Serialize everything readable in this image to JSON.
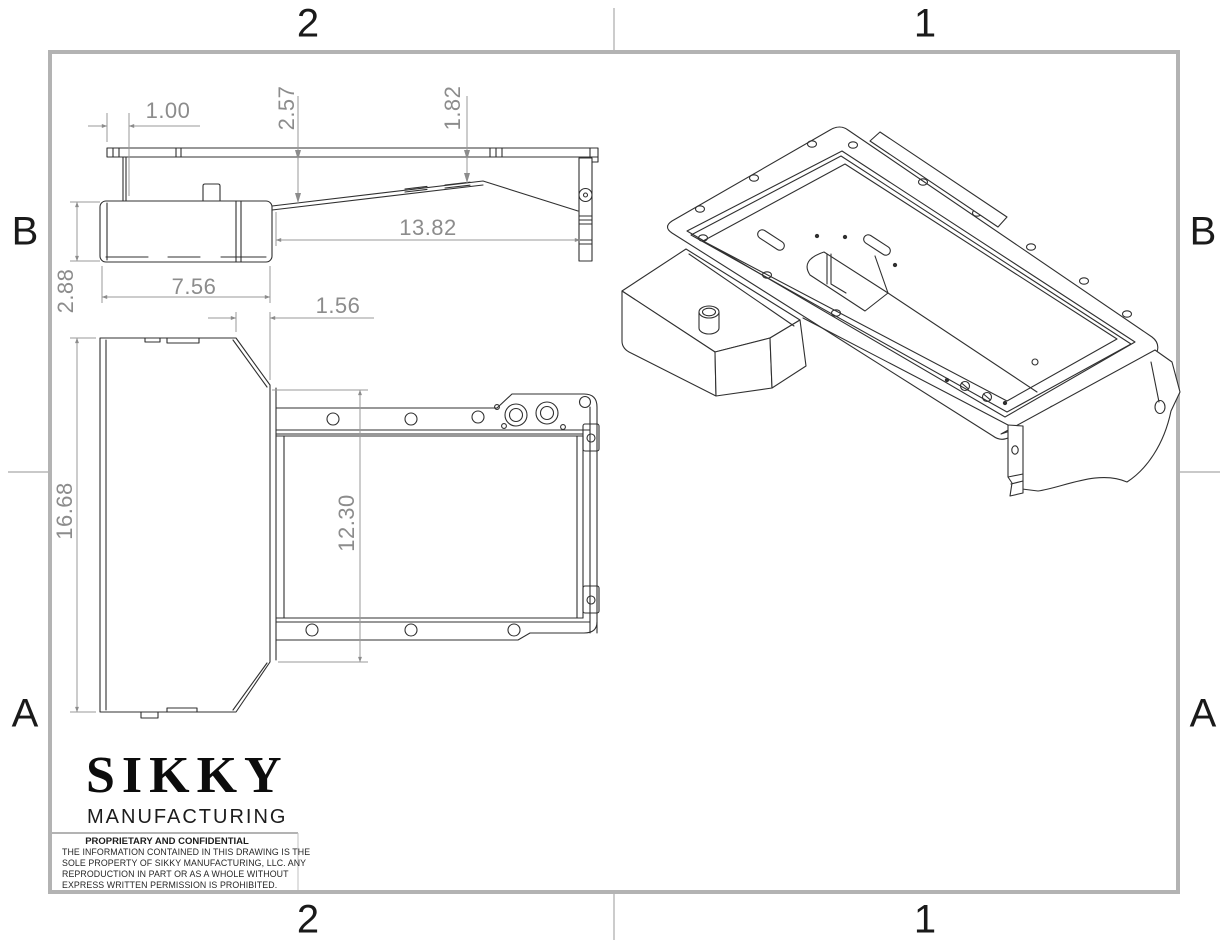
{
  "drawing": {
    "zones": {
      "top_left": "2",
      "top_right": "1",
      "bottom_left": "2",
      "bottom_right": "1",
      "left_upper": "B",
      "left_lower": "A",
      "right_upper": "B",
      "right_lower": "A"
    },
    "views": {
      "side_view": {
        "label": "side profile view",
        "dims": {
          "d100": "1.00",
          "d257": "2.57",
          "d182": "1.82",
          "d1382": "13.82",
          "d288": "2.88",
          "d756": "7.56"
        }
      },
      "plan_view": {
        "label": "bottom plan view",
        "dims": {
          "d156": "1.56",
          "d1668": "16.68",
          "d1230": "12.30"
        }
      },
      "isometric_view": {
        "label": "isometric view of oil pan"
      }
    },
    "title_block": {
      "brand": "SIKKY",
      "division": "MANUFACTURING",
      "notice_title": "PROPRIETARY AND CONFIDENTIAL",
      "notice_lines": [
        "THE INFORMATION CONTAINED IN THIS DRAWING IS THE",
        "SOLE PROPERTY OF SIKKY MANUFACTURING, LLC.  ANY",
        "REPRODUCTION IN PART OR AS A WHOLE WITHOUT",
        "EXPRESS WRITTEN PERMISSION IS PROHIBITED."
      ]
    },
    "colors": {
      "frame": "#b3b3b3",
      "part_line": "#303030",
      "dimension": "#8c8c8c",
      "background": "#ffffff"
    }
  }
}
